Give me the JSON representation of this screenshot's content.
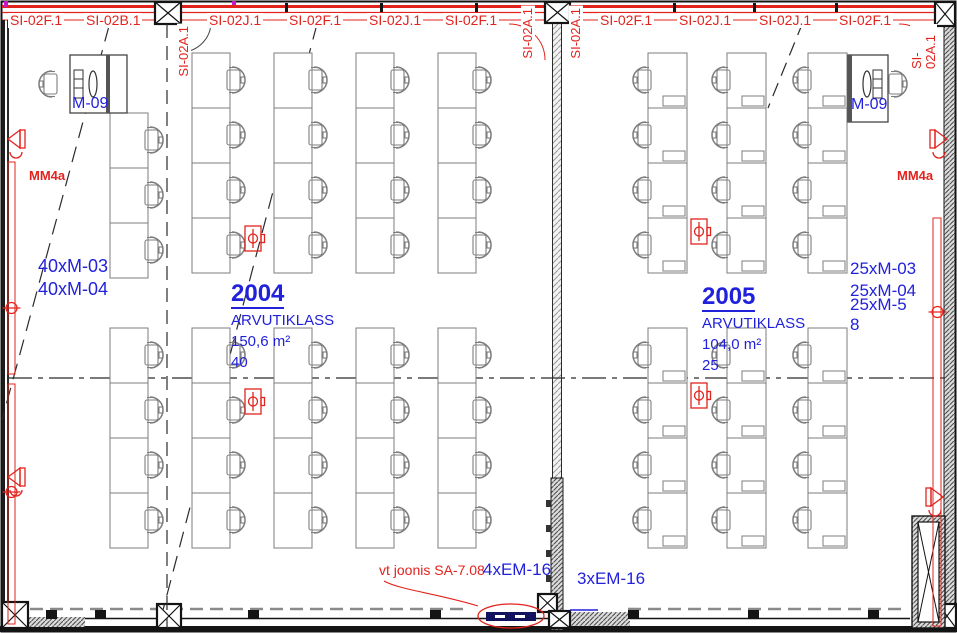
{
  "colors": {
    "red": "#e2231d",
    "blue": "#2121dc",
    "wall": "#141414",
    "desk_gray": "#7d7d7d",
    "hatch_gray": "#8a8a8a",
    "navy": "#12125e",
    "magenta": "#c816c8"
  },
  "fire_labels": {
    "horizontal": [
      {
        "text": "SI-02F.1",
        "x": 8
      },
      {
        "text": "SI-02B.1",
        "x": 84
      },
      {
        "text": "SI-02J.1",
        "x": 207
      },
      {
        "text": "SI-02F.1",
        "x": 287
      },
      {
        "text": "SI-02J.1",
        "x": 367
      },
      {
        "text": "SI-02F.1",
        "x": 443
      },
      {
        "text": "SI-02F.1",
        "x": 598
      },
      {
        "text": "SI-02J.1",
        "x": 677
      },
      {
        "text": "SI-02J.1",
        "x": 757
      },
      {
        "text": "SI-02F.1",
        "x": 837
      }
    ],
    "vertical": [
      {
        "text": "SI-02A.1",
        "x": 177,
        "y": 24
      },
      {
        "text": "SI-02A.1",
        "x": 521,
        "y": 6
      },
      {
        "text": "SI-02A.1",
        "x": 569,
        "y": 6
      },
      {
        "text": "SI-02A.1",
        "x": 910,
        "y": 24
      }
    ]
  },
  "rooms": [
    {
      "number": "2004",
      "name": "ARVUTIKLASS",
      "area": "150,6 m²",
      "capacity": "40"
    },
    {
      "number": "2005",
      "name": "ARVUTIKLASS",
      "area": "104,0 m²",
      "capacity": "25"
    }
  ],
  "equipment_labels": {
    "left": [
      {
        "text": "40xM-03"
      },
      {
        "text": "40xM-04"
      }
    ],
    "right": [
      {
        "text": "25xM-03"
      },
      {
        "text": "25xM-04"
      },
      {
        "text": "25xM-5"
      },
      {
        "text": "8"
      }
    ]
  },
  "teacher_station_label": "M-09",
  "mm_label": "MM4a",
  "note": {
    "text": "vt joonis SA-7.08"
  },
  "em_labels": [
    {
      "text": "4xEM-16"
    },
    {
      "text": "3xEM-16"
    }
  ],
  "plan": {
    "width": 957,
    "height": 633,
    "desk_rooms": [
      {
        "chair_side": "right",
        "desk_w": 38,
        "desk_h": 55,
        "inner": false,
        "strips": [
          {
            "x": 110,
            "rows": [
              113,
              168,
              223,
              328,
              383,
              438,
              493
            ]
          },
          {
            "x": 192,
            "rows": [
              53,
              108,
              163,
              218,
              328,
              383,
              438,
              493
            ]
          },
          {
            "x": 274,
            "rows": [
              53,
              108,
              163,
              218,
              328,
              383,
              438,
              493
            ]
          },
          {
            "x": 356,
            "rows": [
              53,
              108,
              163,
              218,
              328,
              383,
              438,
              493
            ]
          },
          {
            "x": 438,
            "rows": [
              53,
              108,
              163,
              218,
              328,
              383,
              438,
              493
            ]
          }
        ]
      },
      {
        "chair_side": "left",
        "desk_w": 39,
        "desk_h": 55,
        "inner": true,
        "strips": [
          {
            "x": 648,
            "rows": [
              53,
              108,
              163,
              218,
              328,
              383,
              438,
              493
            ]
          },
          {
            "x": 727,
            "rows": [
              53,
              108,
              163,
              218,
              328,
              383,
              438,
              493
            ]
          },
          {
            "x": 808,
            "rows": [
              53,
              108,
              163,
              218,
              328,
              383,
              438,
              493
            ]
          }
        ]
      }
    ],
    "teacher_stations": [
      {
        "x": 70,
        "y": 55,
        "w": 57,
        "h": 58,
        "divider": "right",
        "chair": "left"
      },
      {
        "x": 848,
        "y": 55,
        "w": 40,
        "h": 67,
        "divider": "left",
        "chair": "right"
      }
    ],
    "junction_boxes": [
      [
        245,
        226
      ],
      [
        245,
        389
      ],
      [
        691,
        219
      ],
      [
        691,
        383
      ]
    ],
    "speakers_left": [
      [
        8,
        128
      ],
      [
        8,
        466
      ]
    ],
    "speakers_right": [
      [
        947,
        128
      ],
      [
        943,
        486
      ]
    ],
    "circle_taps": [
      [
        11.5,
        308
      ],
      [
        11.5,
        492
      ],
      [
        937.5,
        312
      ]
    ],
    "conduits": [
      [
        8,
        162,
        7,
        212
      ],
      [
        8,
        384,
        7,
        240
      ],
      [
        933,
        218,
        8,
        408
      ]
    ],
    "columns": [
      [
        155,
        2,
        26,
        22
      ],
      [
        545,
        2,
        25,
        21
      ],
      [
        935,
        2,
        20,
        24
      ],
      [
        2,
        602,
        26,
        26
      ],
      [
        157,
        604,
        24,
        24
      ],
      [
        538,
        594,
        19,
        18
      ],
      [
        549,
        611,
        21,
        17
      ],
      [
        938,
        604,
        18,
        24
      ]
    ],
    "top_ticks": [
      285,
      380,
      475,
      673,
      753,
      835
    ],
    "mullions": [
      46,
      95,
      248,
      430,
      628,
      748,
      868
    ]
  }
}
